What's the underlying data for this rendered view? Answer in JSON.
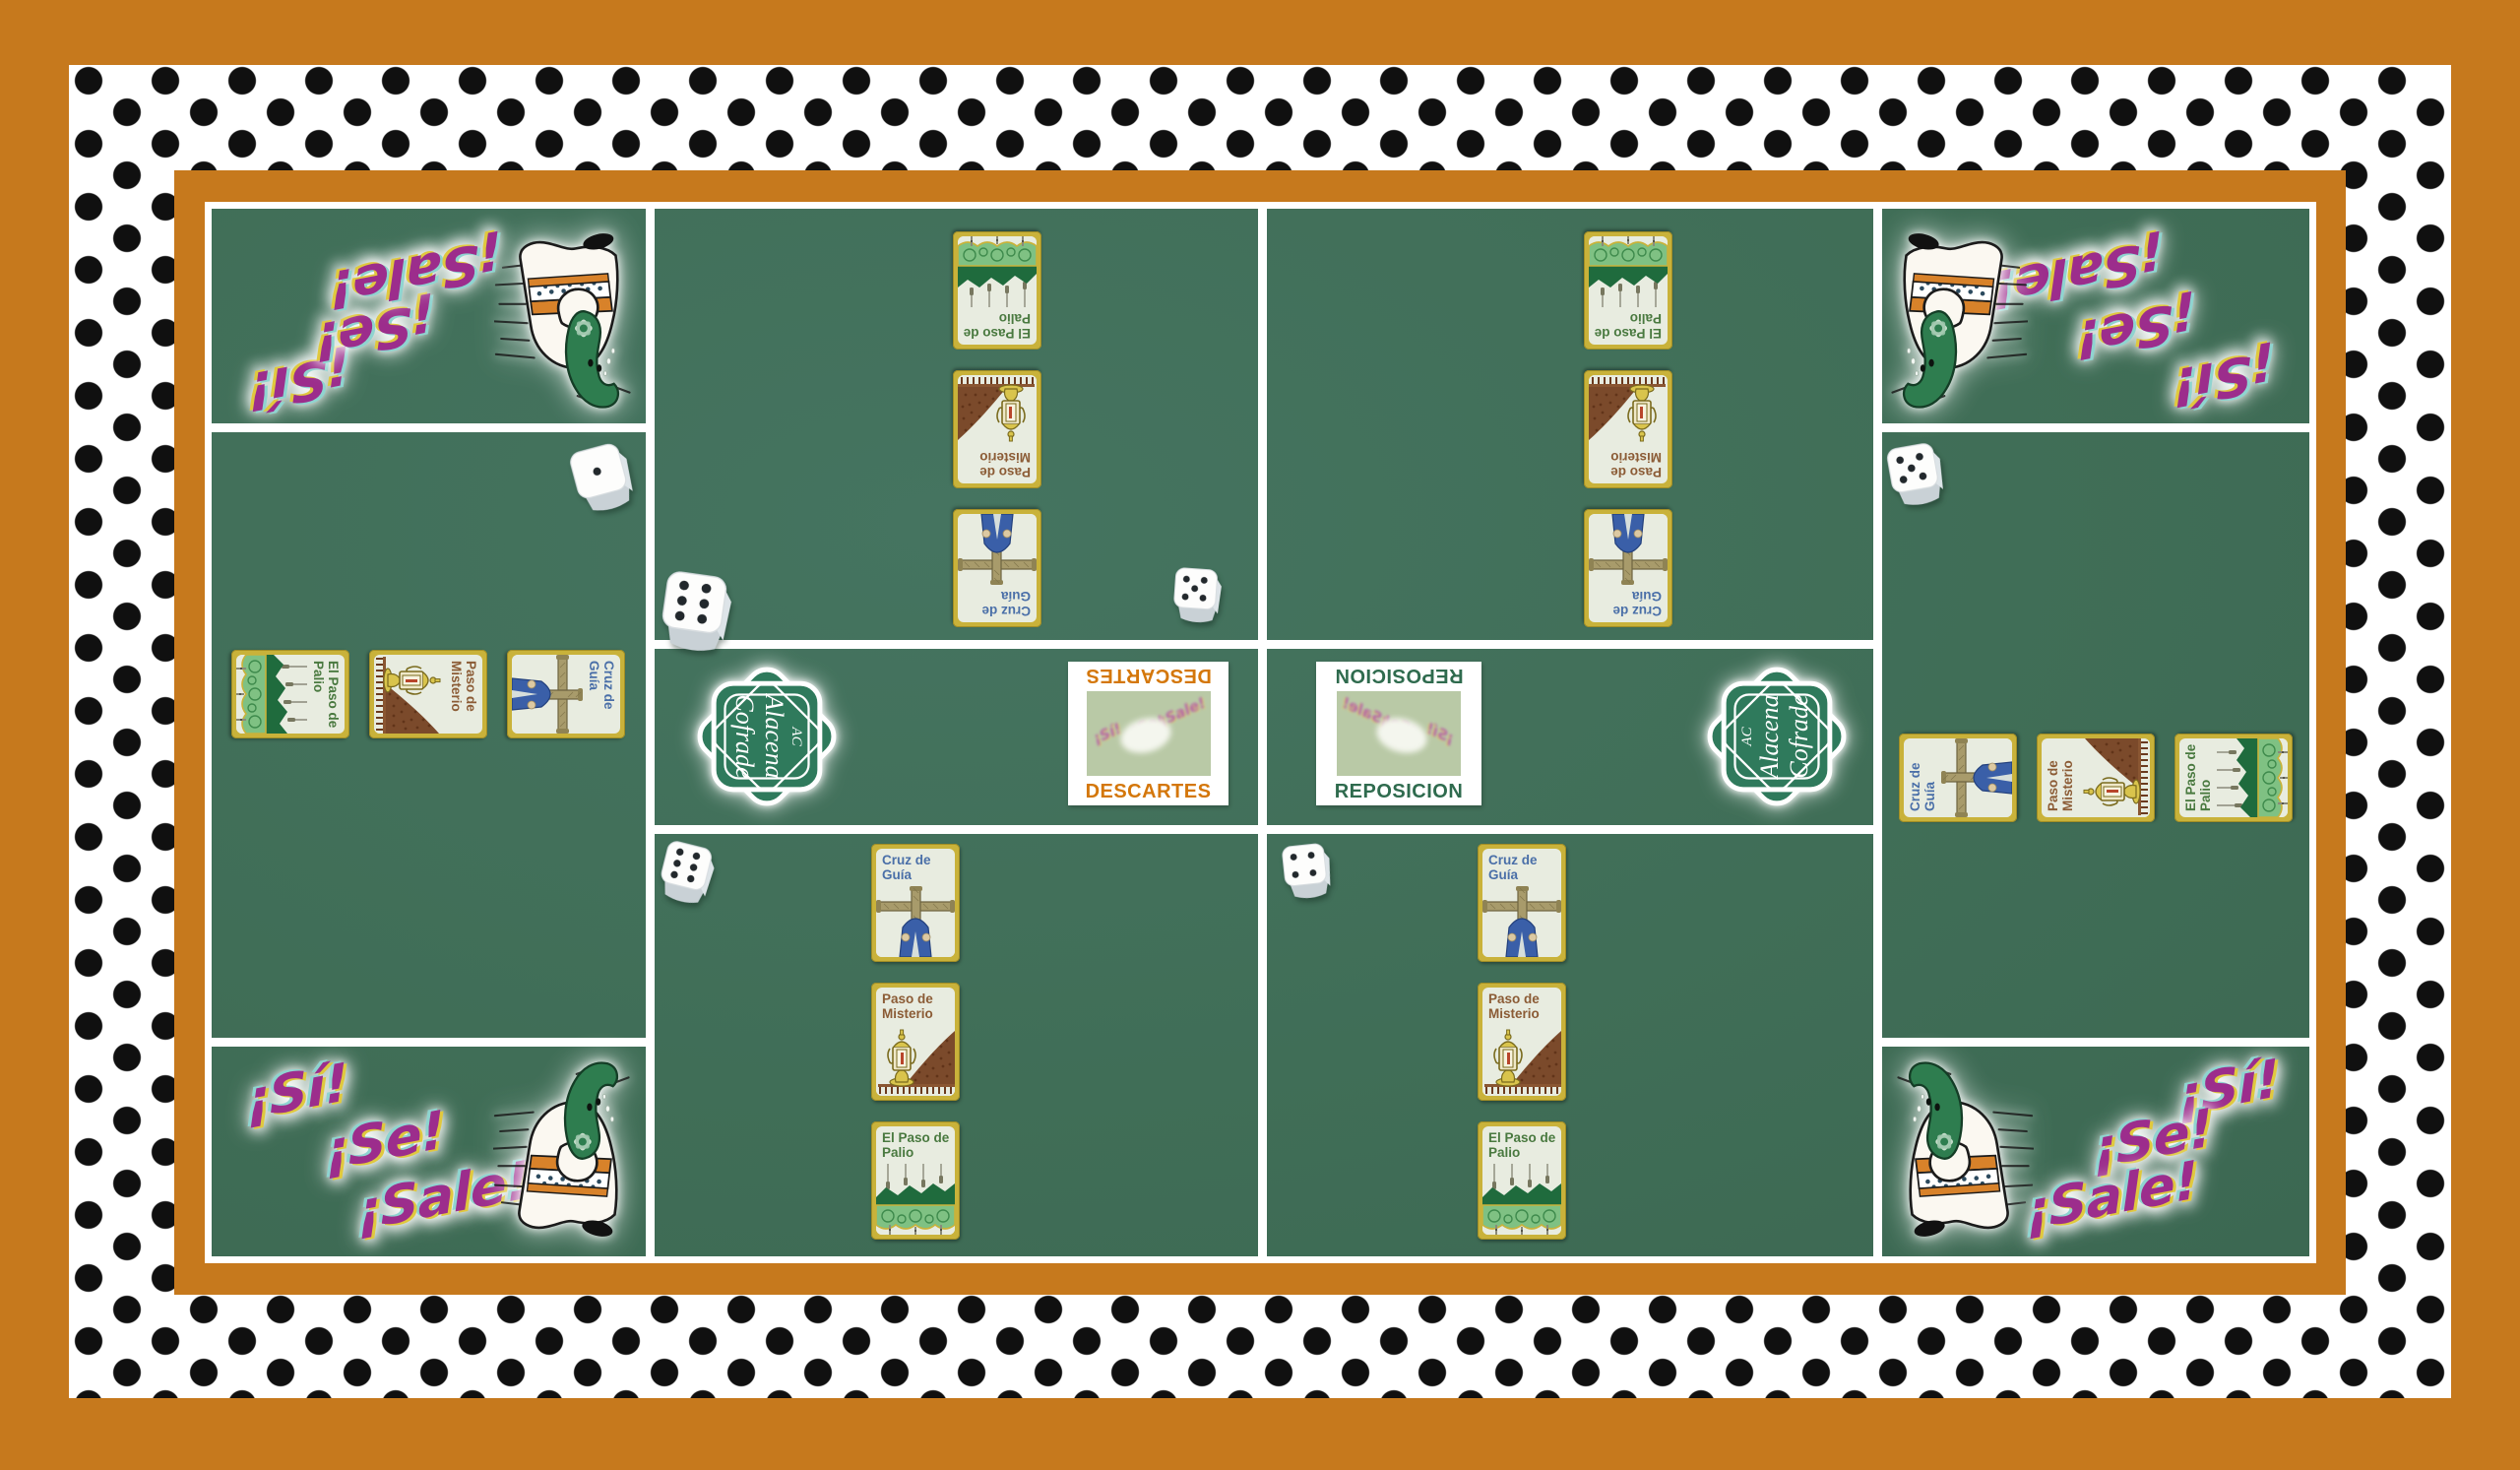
{
  "board_game": {
    "shout": {
      "line1": "¡Sí!",
      "line2": "¡Se!",
      "line3": "¡Sale!"
    },
    "brand": {
      "monogram": "AC",
      "name_line1": "Alacena",
      "name_line2": "Cofrade"
    },
    "zones": {
      "descartes_label": "DESCARTES",
      "reposicion_label": "REPOSICION"
    },
    "card_types": [
      {
        "id": "cruz-de-guia",
        "title": "Cruz de Guía"
      },
      {
        "id": "paso-de-misterio",
        "title": "Paso de Misterio"
      },
      {
        "id": "el-paso-de-palio",
        "title": "El Paso de Palio"
      }
    ],
    "dice": [
      {
        "pips": 1
      },
      {
        "pips": 6
      },
      {
        "pips": 5
      },
      {
        "pips": 5
      },
      {
        "pips": 6
      },
      {
        "pips": 4
      }
    ],
    "colors": {
      "mat_orange": "#C6791D",
      "band_white": "#FFFFFF",
      "dot_black": "#101010",
      "board_green": "#406E57",
      "line_white": "#FFFFFF",
      "card_border_gold": "#C9B23A",
      "card_bg": "#E8ECE0",
      "title_blue": "#4A6FA8",
      "title_brown": "#8B5B35",
      "title_green": "#49793F",
      "descartes_orange": "#D4770B",
      "reposicion_green": "#2F6B4E",
      "shout_magenta": "#9C2D8C",
      "logo_green": "#2F7A5C"
    }
  }
}
